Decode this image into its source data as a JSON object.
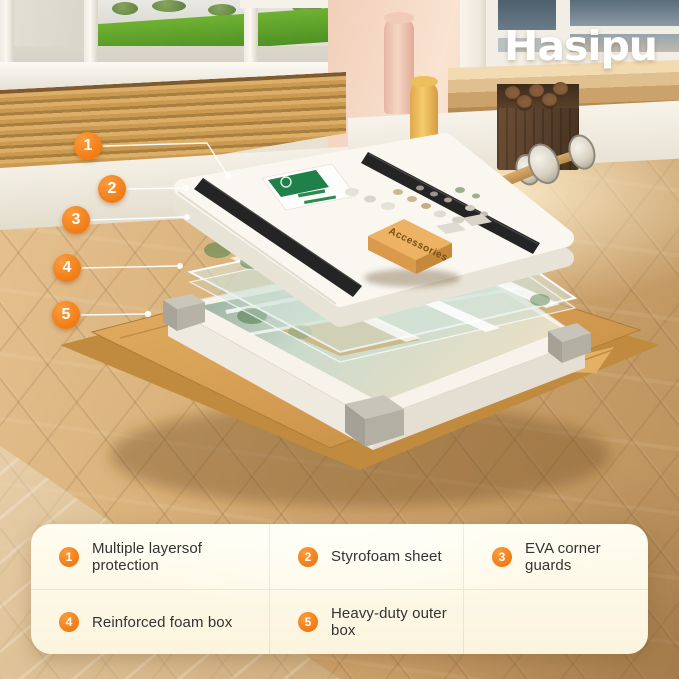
{
  "brand": {
    "logo_text": "Hasipu"
  },
  "package": {
    "accessories_box_label": "Accessories"
  },
  "callouts": [
    {
      "number": "1",
      "label": "Multiple layersof protection"
    },
    {
      "number": "2",
      "label": "Styrofoam sheet"
    },
    {
      "number": "3",
      "label": "EVA corner guards"
    },
    {
      "number": "4",
      "label": "Reinforced foam box"
    },
    {
      "number": "5",
      "label": "Heavy-duty outer box"
    }
  ],
  "colors": {
    "accent_orange": "#F6821F",
    "legend_bg": "#FFFDF0",
    "cardboard": "#D49C52",
    "foam_white": "#F6F2EA",
    "eva_black": "#242424",
    "logo_white": "#FFFFFF"
  }
}
